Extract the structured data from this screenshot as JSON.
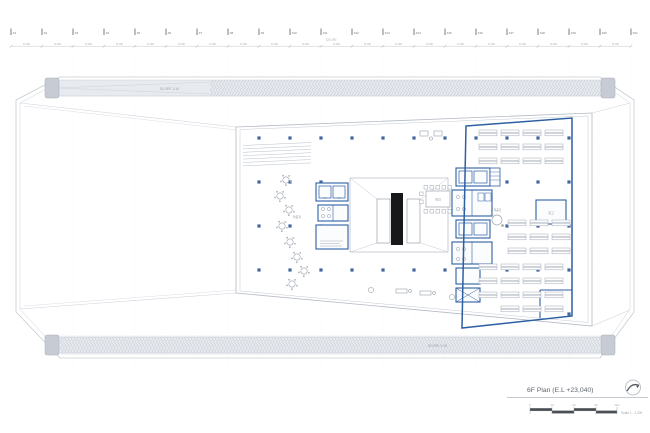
{
  "title_block": {
    "title": "6F Plan (E.L +23,040)",
    "scale_label": "Scale 1 : 1,200",
    "scale_ticks": [
      "0",
      "10",
      "20",
      "30",
      "40m"
    ]
  },
  "grid": {
    "labels": [
      "X1",
      "X2",
      "X3",
      "X4",
      "X5",
      "X6",
      "X7",
      "X8",
      "X9",
      "X10",
      "X11",
      "X12",
      "X13",
      "X14",
      "X15",
      "X16",
      "X17",
      "X18",
      "X19",
      "X20",
      "X21"
    ],
    "bay_dim": "8,100",
    "overall_dim": "110,100"
  },
  "annotations": {
    "slope_top": "SLOPE 1:10",
    "slope_bottom": "SLOPE 1:10"
  },
  "rooms": {
    "lounge": "라운지",
    "meeting": "회의",
    "pantry": "휴게공간",
    "storage": "창고"
  },
  "colors": {
    "accent_blue": "#2e5fa3",
    "column_blue": "#41659e",
    "line_gray": "#c3c8d1",
    "furniture_gray": "#9aa2ae",
    "band_fill": "#e7eaef",
    "band_cap": "#c6cbd4",
    "escalator_black": "#17181a",
    "text_gray": "#7d838d"
  }
}
